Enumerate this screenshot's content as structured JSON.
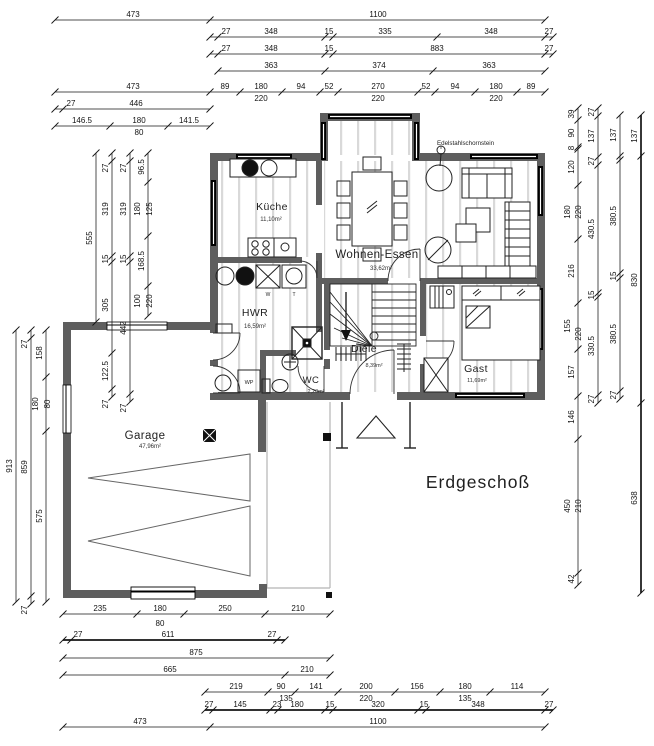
{
  "title": {
    "text": "Erdgeschoß"
  },
  "plan": {
    "rooms": [
      {
        "name": "Küche",
        "area": "11,10m²"
      },
      {
        "name": "Wohnen-Essen",
        "area": "33,62m²"
      },
      {
        "name": "HWR",
        "area": "16,59m²"
      },
      {
        "name": "WC",
        "area": "2,20m²"
      },
      {
        "name": "Diele",
        "area": "8,39m²"
      },
      {
        "name": "Gast",
        "area": "11,69m²"
      },
      {
        "name": "Garage",
        "area": "47,96m²"
      }
    ],
    "annotations": {
      "chimney": "Edelstahlschornstein"
    },
    "fixtures": {
      "heat_pump": "WP",
      "washer": "W",
      "dryer": "T"
    },
    "colors": {
      "wall": "#5e5e5e",
      "window": "#000000",
      "floor_stripe": "#d9d9d9",
      "dim": "#141414"
    }
  },
  "dimensions": {
    "chains": [
      {
        "o": "h",
        "p": 20,
        "a": 55,
        "b": 545,
        "t": [
          55,
          210,
          545
        ],
        "L": [
          [
            "473",
            133,
            17
          ],
          [
            "1100",
            378,
            17
          ]
        ]
      },
      {
        "o": "h",
        "p": 37,
        "a": 210,
        "b": 553,
        "t": [
          210,
          218,
          325,
          333,
          437,
          545,
          553
        ],
        "L": [
          [
            "27",
            226,
            34
          ],
          [
            "348",
            271,
            34
          ],
          [
            "15",
            329,
            34
          ],
          [
            "335",
            385,
            34
          ],
          [
            "348",
            491,
            34
          ],
          [
            "27",
            549,
            34
          ]
        ]
      },
      {
        "o": "h",
        "p": 54,
        "a": 210,
        "b": 553,
        "t": [
          210,
          218,
          325,
          333,
          545,
          553
        ],
        "L": [
          [
            "27",
            226,
            51
          ],
          [
            "348",
            271,
            51
          ],
          [
            "15",
            329,
            51
          ],
          [
            "883",
            437,
            51
          ],
          [
            "27",
            549,
            51
          ]
        ]
      },
      {
        "o": "h",
        "p": 71,
        "a": 218,
        "b": 545,
        "t": [
          218,
          325,
          433,
          545
        ],
        "L": [
          [
            "363",
            271,
            68
          ],
          [
            "374",
            379,
            68
          ],
          [
            "363",
            489,
            68
          ]
        ]
      },
      {
        "o": "h",
        "p": 92,
        "a": 55,
        "b": 545,
        "t": [
          55,
          210,
          240,
          282,
          320,
          338,
          418,
          435,
          475,
          517,
          545
        ],
        "L": [
          [
            "473",
            133,
            89
          ],
          [
            "89",
            225,
            89
          ],
          [
            "180",
            261,
            89
          ],
          [
            "220",
            261,
            101
          ],
          [
            "94",
            301,
            89
          ],
          [
            "52",
            329,
            89
          ],
          [
            "270",
            378,
            89
          ],
          [
            "220",
            378,
            101
          ],
          [
            "52",
            426,
            89
          ],
          [
            "94",
            455,
            89
          ],
          [
            "180",
            496,
            89
          ],
          [
            "220",
            496,
            101
          ],
          [
            "89",
            531,
            89
          ]
        ]
      },
      {
        "o": "h",
        "p": 109,
        "a": 55,
        "b": 210,
        "t": [
          55,
          63,
          210
        ],
        "L": [
          [
            "27",
            71,
            106
          ],
          [
            "446",
            136,
            106
          ]
        ]
      },
      {
        "o": "h",
        "p": 126,
        "a": 55,
        "b": 210,
        "t": [
          55,
          110,
          168,
          210
        ],
        "L": [
          [
            "146.5",
            82,
            123
          ],
          [
            "180",
            139,
            123
          ],
          [
            "80",
            139,
            135
          ],
          [
            "141.5",
            189,
            123
          ]
        ]
      },
      {
        "o": "h",
        "p": 614,
        "a": 63,
        "b": 330,
        "t": [
          63,
          137,
          184,
          265,
          330
        ],
        "L": [
          [
            "235",
            100,
            611
          ],
          [
            "180",
            160,
            611
          ],
          [
            "80",
            160,
            626
          ],
          [
            "250",
            225,
            611
          ],
          [
            "210",
            298,
            611
          ]
        ]
      },
      {
        "o": "h",
        "p": 640,
        "a": 63,
        "b": 285,
        "w": 1,
        "t": [
          63,
          71,
          277,
          285
        ],
        "L": [
          [
            "27",
            78,
            637
          ],
          [
            "611",
            168,
            637
          ],
          [
            "27",
            272,
            637
          ]
        ]
      },
      {
        "o": "h",
        "p": 658,
        "a": 63,
        "b": 330,
        "t": [
          63,
          330
        ],
        "L": [
          [
            "875",
            196,
            655
          ]
        ]
      },
      {
        "o": "h",
        "p": 675,
        "a": 63,
        "b": 330,
        "t": [
          63,
          285,
          330
        ],
        "L": [
          [
            "665",
            170,
            672
          ],
          [
            "210",
            307,
            672
          ]
        ]
      },
      {
        "o": "h",
        "p": 692,
        "a": 205,
        "b": 545,
        "t": [
          205,
          268,
          295,
          338,
          395,
          440,
          490,
          545
        ],
        "L": [
          [
            "219",
            236,
            689
          ],
          [
            "90",
            281,
            689
          ],
          [
            "135",
            286,
            701
          ],
          [
            "141",
            316,
            689
          ],
          [
            "200",
            366,
            689
          ],
          [
            "220",
            366,
            701
          ],
          [
            "156",
            417,
            689
          ],
          [
            "180",
            465,
            689
          ],
          [
            "135",
            465,
            701
          ],
          [
            "114",
            517,
            689
          ]
        ]
      },
      {
        "o": "h",
        "p": 710,
        "a": 205,
        "b": 553,
        "w": 1,
        "t": [
          205,
          213,
          270,
          278,
          325,
          333,
          418,
          426,
          545,
          553
        ],
        "L": [
          [
            "27",
            209,
            707
          ],
          [
            "145",
            240,
            707
          ],
          [
            "23",
            277,
            707
          ],
          [
            "180",
            297,
            707
          ],
          [
            "15",
            330,
            707
          ],
          [
            "320",
            378,
            707
          ],
          [
            "15",
            424,
            707
          ],
          [
            "348",
            478,
            707
          ],
          [
            "27",
            549,
            707
          ]
        ]
      },
      {
        "o": "h",
        "p": 727,
        "a": 63,
        "b": 545,
        "t": [
          63,
          210,
          545
        ],
        "L": [
          [
            "473",
            140,
            724
          ],
          [
            "1100",
            378,
            724
          ]
        ]
      },
      {
        "o": "v",
        "p": 96,
        "a": 153,
        "b": 322,
        "t": [
          153,
          322
        ],
        "L": [
          [
            "555",
            92,
            238
          ]
        ]
      },
      {
        "o": "v",
        "p": 112,
        "a": 153,
        "b": 397,
        "t": [
          153,
          161,
          256,
          262,
          353,
          389,
          397
        ],
        "L": [
          [
            "27",
            108,
            168
          ],
          [
            "319",
            108,
            209
          ],
          [
            "15",
            108,
            259
          ],
          [
            "305",
            108,
            305
          ],
          [
            "122.5",
            108,
            371
          ],
          [
            "27",
            108,
            404
          ]
        ]
      },
      {
        "o": "v",
        "p": 130,
        "a": 153,
        "b": 402,
        "t": [
          153,
          161,
          256,
          262,
          394,
          402
        ],
        "L": [
          [
            "27",
            126,
            168
          ],
          [
            "319",
            126,
            209
          ],
          [
            "15",
            126,
            259
          ],
          [
            "442",
            126,
            328
          ],
          [
            "27",
            126,
            408
          ]
        ]
      },
      {
        "o": "v",
        "p": 148,
        "a": 153,
        "b": 316,
        "t": [
          153,
          182,
          236,
          286,
          316
        ],
        "L": [
          [
            "96.5",
            144,
            167
          ],
          [
            "180",
            140,
            209
          ],
          [
            "125",
            152,
            209
          ],
          [
            "168.5",
            144,
            261
          ],
          [
            "100",
            140,
            301
          ],
          [
            "220",
            152,
            301
          ]
        ]
      },
      {
        "o": "v",
        "p": 16,
        "a": 330,
        "b": 602,
        "t": [
          330,
          602
        ],
        "L": [
          [
            "913",
            12,
            466
          ]
        ]
      },
      {
        "o": "v",
        "p": 31,
        "a": 330,
        "b": 604,
        "t": [
          330,
          338,
          596,
          604
        ],
        "L": [
          [
            "27",
            27,
            344
          ],
          [
            "859",
            27,
            467
          ],
          [
            "27",
            27,
            610
          ]
        ]
      },
      {
        "o": "v",
        "p": 46,
        "a": 330,
        "b": 602,
        "t": [
          330,
          377,
          431,
          602
        ],
        "L": [
          [
            "158",
            42,
            353
          ],
          [
            "180",
            38,
            404
          ],
          [
            "80",
            50,
            404
          ],
          [
            "575",
            42,
            516
          ]
        ]
      },
      {
        "o": "v",
        "p": 578,
        "a": 108,
        "b": 585,
        "t": [
          108,
          120,
          147,
          149,
          185,
          239,
          303,
          349,
          396,
          439,
          573,
          585
        ],
        "L": [
          [
            "39",
            574,
            114
          ],
          [
            "90",
            574,
            133
          ],
          [
            "8",
            574,
            148
          ],
          [
            "120",
            574,
            167
          ],
          [
            "180",
            570,
            212
          ],
          [
            "220",
            581,
            212
          ],
          [
            "216",
            574,
            271
          ],
          [
            "155",
            570,
            326
          ],
          [
            "220",
            581,
            334
          ],
          [
            "157",
            574,
            372
          ],
          [
            "146",
            574,
            417
          ],
          [
            "450",
            570,
            506
          ],
          [
            "210",
            581,
            506
          ],
          [
            "42",
            574,
            579
          ]
        ]
      },
      {
        "o": "v",
        "p": 598,
        "a": 108,
        "b": 403,
        "t": [
          108,
          116,
          157,
          165,
          293,
          297,
          395,
          403
        ],
        "L": [
          [
            "27",
            594,
            112
          ],
          [
            "137",
            594,
            136
          ],
          [
            "27",
            594,
            161
          ],
          [
            "430.5",
            594,
            229
          ],
          [
            "15",
            594,
            295
          ],
          [
            "330.5",
            594,
            346
          ],
          [
            "27",
            594,
            399
          ]
        ]
      },
      {
        "o": "v",
        "p": 620,
        "a": 115,
        "b": 399,
        "t": [
          115,
          156,
          160,
          273,
          278,
          391,
          399
        ],
        "L": [
          [
            "137",
            616,
            135
          ],
          [
            "380.5",
            616,
            216
          ],
          [
            "15",
            616,
            276
          ],
          [
            "380.5",
            616,
            334
          ],
          [
            "27",
            616,
            395
          ]
        ]
      },
      {
        "o": "v",
        "p": 641,
        "a": 115,
        "b": 593,
        "w": 1,
        "t": [
          115,
          156,
          403,
          593
        ],
        "L": [
          [
            "137",
            637,
            136
          ],
          [
            "830",
            637,
            280
          ],
          [
            "638",
            637,
            498
          ]
        ]
      }
    ]
  }
}
